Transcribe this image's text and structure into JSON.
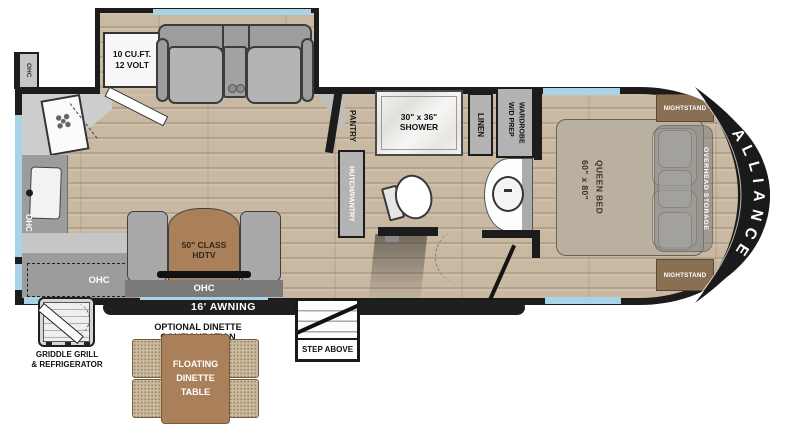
{
  "brand": "ALLIANCE",
  "labels": {
    "ohc": "OHC"
  },
  "living": {
    "refrigerator": {
      "line1": "10 CU.FT.",
      "line2": "12 VOLT"
    },
    "tv": {
      "line1": "50\" CLASS",
      "line2": "HDTV"
    }
  },
  "bath": {
    "pantry": "PANTRY",
    "hutch_pantry": "HUTCH/PANTRY",
    "shower": {
      "line1": "30\" x 36\"",
      "line2": "SHOWER"
    },
    "linen": "LINEN",
    "wardrobe": {
      "line1": "WARDROBE",
      "line2": "W/D PREP"
    }
  },
  "bedroom": {
    "bed": {
      "line1": "QUEEN BED",
      "line2": "60\" x 80\""
    },
    "nightstand": "NIGHTSTAND",
    "overhead_storage": "OVERHEAD STORAGE"
  },
  "exterior": {
    "awning": "16' AWNING",
    "step": "STEP ABOVE",
    "griddle": {
      "line1": "GRIDDLE GRILL",
      "line2": "& REFRIGERATOR"
    }
  },
  "optional_dinette": {
    "header": "OPTIONAL DINETTE CONFIGURATION",
    "table": {
      "line1": "FLOATING",
      "line2": "DINETTE",
      "line3": "TABLE"
    }
  },
  "colors": {
    "wall": "#1c1c1c",
    "window": "#a9d3e6",
    "floor": "#c9b9a2",
    "wood_accent": "#a9805a",
    "counter": "#9c9c9c",
    "cabinet": "#b3b3b3",
    "bed": "#b9b0a2",
    "nightstand": "#8a6f52",
    "dinette_fabric": "#cdbb9e"
  }
}
